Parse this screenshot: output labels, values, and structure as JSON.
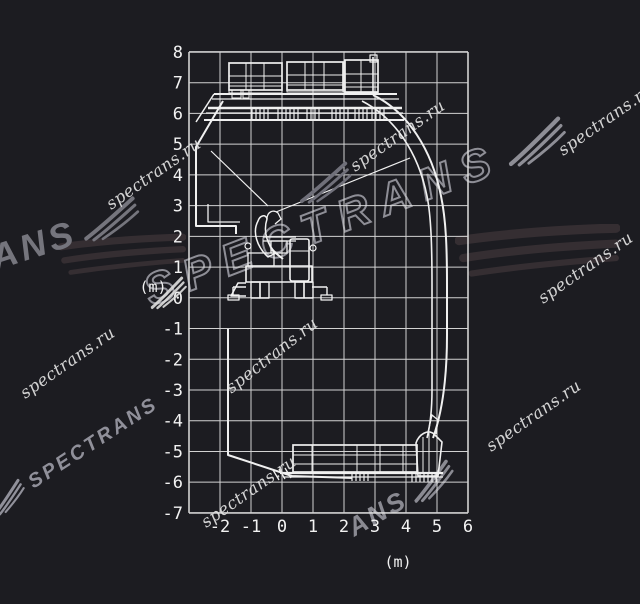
{
  "watermarks": {
    "url": "spectrans.ru",
    "brand": "SPECTRANS",
    "brand_partial_ans": "ANS",
    "brand_partial_trans": "ANS"
  },
  "axes": {
    "unit": "(m)",
    "x": {
      "ticks": [
        "-2",
        "-1",
        "0",
        "1",
        "2",
        "3",
        "4",
        "5",
        "6"
      ],
      "min": -3,
      "max": 6
    },
    "y": {
      "ticks": [
        "8",
        "7",
        "6",
        "5",
        "4",
        "3",
        "2",
        "1",
        "0",
        "-1",
        "-2",
        "-3",
        "-4",
        "-5",
        "-6",
        "-7"
      ],
      "min": -7,
      "max": 8
    }
  },
  "chart_data": {
    "type": "diagram",
    "title": "Excavator working-range envelope with upper and lower railway cars",
    "x_range_m": [
      -3,
      6
    ],
    "y_range_m": [
      -7,
      8
    ],
    "grid_step_m": 1,
    "envelope_points_m": {
      "upper_left_diagonal": [
        [
          -1.9,
          6.4
        ],
        [
          -2.8,
          4.9
        ]
      ],
      "left_vertical": [
        [
          -2.8,
          4.9
        ],
        [
          -2.8,
          2.3
        ]
      ],
      "left_step": [
        [
          -2.8,
          2.3
        ],
        [
          -1.5,
          2.3
        ]
      ],
      "lower_left_vertical": [
        [
          -1.7,
          -1.0
        ],
        [
          -1.7,
          -5.1
        ]
      ],
      "bottom_diagonal": [
        [
          -1.7,
          -5.1
        ],
        [
          0.3,
          -5.8
        ]
      ],
      "outer_arc": [
        [
          2.9,
          6.6
        ],
        [
          5.1,
          3.3
        ],
        [
          5.3,
          0.4
        ],
        [
          4.9,
          -4.5
        ]
      ],
      "inner_arc": [
        [
          2.6,
          6.4
        ],
        [
          4.7,
          3.3
        ],
        [
          4.8,
          -0.5
        ],
        [
          4.7,
          -4.5
        ]
      ],
      "max_height_pole_m": [
        2.9,
        7.8
      ],
      "max_depth_m": -5.8
    }
  }
}
